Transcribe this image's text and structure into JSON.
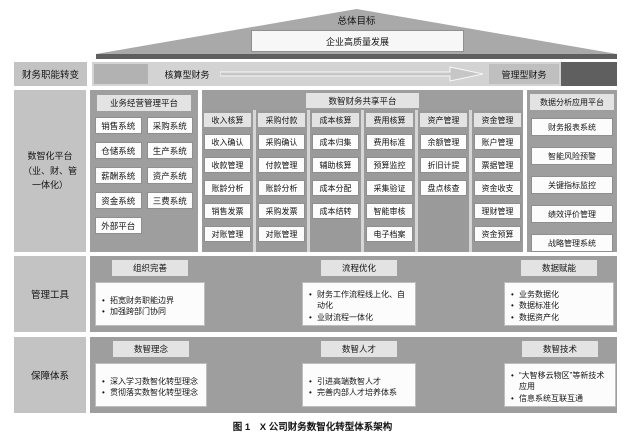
{
  "colors": {
    "roof": "#a9a9a9",
    "beam": "#5f5f5f",
    "side": "#c3c3c3",
    "bar": "#d3d3d3",
    "bar-start": "#b2b2b2",
    "to-box": "#bfbfbf",
    "panel": "#9e9e9e",
    "panel2": "#9a9a9a",
    "col-gap": "#d6d6d6",
    "hdr": "#e3e3e3",
    "item-border": "#8f8f8f",
    "item-bg": "#fcfcfc",
    "ink": "#141414"
  },
  "goal": {
    "label": "总体目标",
    "box": "企业高质量发展"
  },
  "shift": {
    "side": "财务职能转变",
    "from": "核算型财务",
    "to": "管理型财务"
  },
  "platform": {
    "side_lines": [
      "数智化平台",
      "（业、财、管",
      "一体化）"
    ],
    "business": {
      "title": "业务经营管理平台",
      "items": [
        "销售系统",
        "采购系统",
        "仓储系统",
        "生产系统",
        "薪酬系统",
        "资产系统",
        "资金系统",
        "三费系统",
        "外部平台"
      ]
    },
    "shared": {
      "title": "数智财务共享平台",
      "columns": [
        {
          "header": "收入核算",
          "items": [
            "收入确认",
            "收款管理",
            "账龄分析",
            "销售发票",
            "对账管理"
          ]
        },
        {
          "header": "采购付款",
          "items": [
            "采购确认",
            "付款管理",
            "账龄分析",
            "采购发票",
            "对账管理"
          ]
        },
        {
          "header": "成本核算",
          "items": [
            "成本归集",
            "辅助核算",
            "成本分配",
            "成本结转"
          ]
        },
        {
          "header": "费用核算",
          "items": [
            "费用标准",
            "预算监控",
            "采集验证",
            "智能审核",
            "电子档案"
          ]
        },
        {
          "header": "资产管理",
          "items": [
            "余额管理",
            "折旧计提",
            "盘点核查"
          ]
        },
        {
          "header": "资金管理",
          "items": [
            "账户管理",
            "票据管理",
            "资金收支",
            "理财管理",
            "资金预算"
          ]
        }
      ]
    },
    "data": {
      "title": "数据分析应用平台",
      "items": [
        "财务报表系统",
        "智能风险预警",
        "关键指标监控",
        "绩效评价管理",
        "战略管理系统"
      ]
    }
  },
  "tools": {
    "side": "管理工具",
    "groups": [
      {
        "title": "组织完善",
        "bullets": [
          "拓宽财务职能边界",
          "加强跨部门协同"
        ]
      },
      {
        "title": "流程优化",
        "bullets": [
          "财务工作流程线上化、自动化",
          "业财流程一体化"
        ]
      },
      {
        "title": "数据赋能",
        "bullets": [
          "业务数据化",
          "数据标准化",
          "数据资产化"
        ]
      }
    ]
  },
  "guarantee": {
    "side": "保障体系",
    "groups": [
      {
        "title": "数智理念",
        "bullets": [
          "深入学习数智化转型理念",
          "贯彻落实数智化转型理念"
        ]
      },
      {
        "title": "数智人才",
        "bullets": [
          "引进高端数智人才",
          "完善内部人才培养体系"
        ]
      },
      {
        "title": "数智技术",
        "bullets": [
          "“大智移云物区”等新技术应用",
          "信息系统互联互通"
        ]
      }
    ]
  },
  "caption": "图 1　X 公司财务数智化转型体系架构"
}
